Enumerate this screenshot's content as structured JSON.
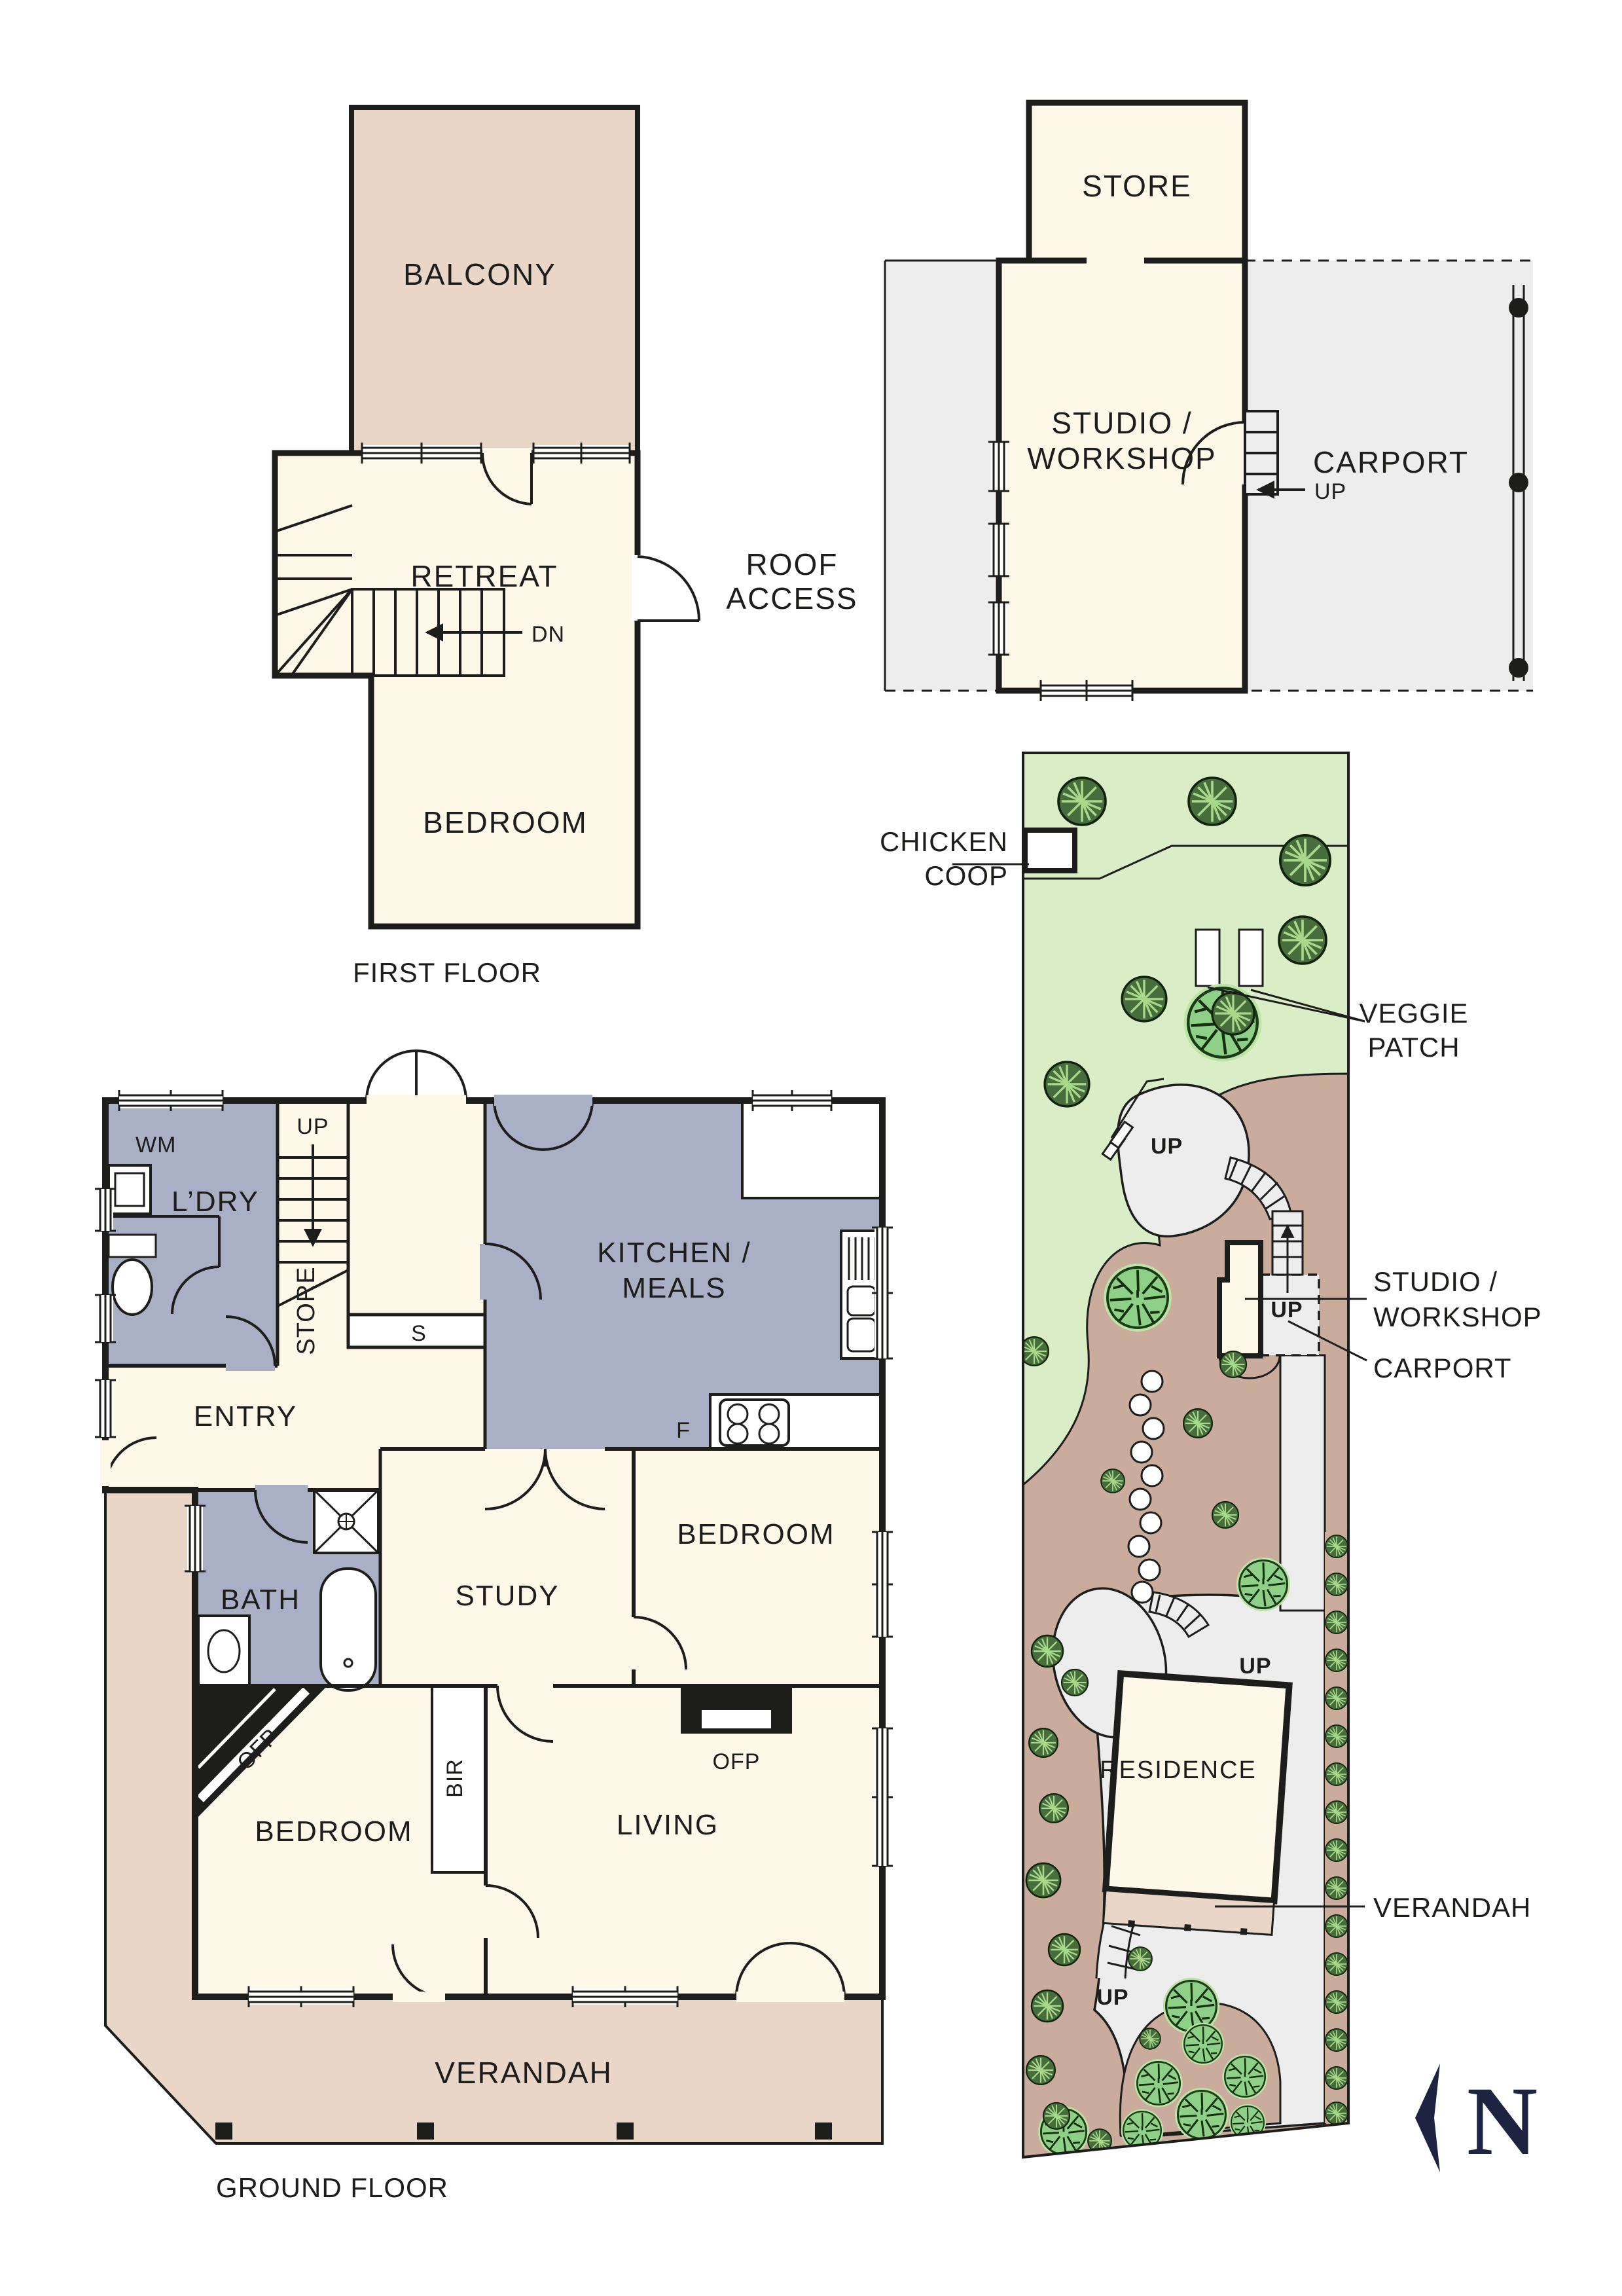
{
  "colors": {
    "wall": "#1d1d1b",
    "cream": "#fdf8e8",
    "tan": "#e9d6c7",
    "grayroom": "#a9b0c6",
    "lawn": "#d9eec6",
    "brown": "#c9ac9c",
    "path": "#ededed",
    "white": "#ffffff",
    "tree": "#8fd089",
    "treehalo": "#bce4a6",
    "bush": "#476d3c",
    "bushline": "#a8d98a",
    "navy": "#1e2342"
  },
  "first_floor": {
    "balcony": "BALCONY",
    "retreat": "RETREAT",
    "roof_access_1": "ROOF",
    "roof_access_2": "ACCESS",
    "dn": "DN",
    "bedroom": "BEDROOM",
    "title": "FIRST FLOOR"
  },
  "outbuilding": {
    "store": "STORE",
    "studio_1": "STUDIO /",
    "studio_2": "WORKSHOP",
    "carport": "CARPORT",
    "up": "UP"
  },
  "ground_floor": {
    "wm": "WM",
    "ldry": "L’DRY",
    "up": "UP",
    "store": "STORE",
    "s": "S",
    "kitchen_1": "KITCHEN /",
    "kitchen_2": "MEALS",
    "f": "F",
    "entry": "ENTRY",
    "bath": "BATH",
    "study": "STUDY",
    "bedroom_mid": "BEDROOM",
    "ofp_corner": "OFP",
    "bir": "BIR",
    "ofp_living": "OFP",
    "bedroom": "BEDROOM",
    "living": "LIVING",
    "verandah": "VERANDAH",
    "title": "GROUND FLOOR"
  },
  "site": {
    "chicken_1": "CHICKEN",
    "chicken_2": "COOP",
    "veggie_1": "VEGGIE",
    "veggie_2": "PATCH",
    "studio_1": "STUDIO /",
    "studio_2": "WORKSHOP",
    "carport": "CARPORT",
    "residence": "RESIDENCE",
    "verandah": "VERANDAH",
    "up_top": "UP",
    "up_carport": "UP",
    "up_res": "UP",
    "up_stairs": "UP",
    "north": "N"
  }
}
